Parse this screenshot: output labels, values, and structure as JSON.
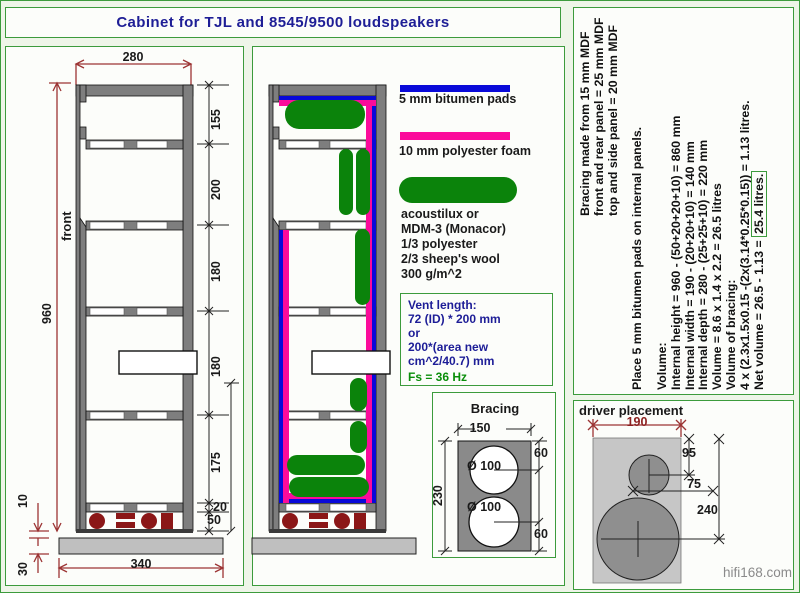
{
  "title": "Cabinet for TJL and 8545/9500 loudspeakers",
  "watermark": "hifi168.com",
  "colors": {
    "border_green": "#3c9b3c",
    "navy_text": "#1d1d97",
    "dim_red": "#9c3434",
    "bitumen_blue": "#0909d9",
    "foam_magenta": "#fb0b9b",
    "acoustilux_green": "#0b830b",
    "wall_gray": "#7e7e7e",
    "feet_dark_red": "#8b1717"
  },
  "left_drawing": {
    "front_label": "front",
    "dim_width": "280",
    "dim_height": "960",
    "dim_s1": "155",
    "dim_s2": "200",
    "dim_s3": "180",
    "dim_s4": "180",
    "dim_s5": "175",
    "dim_s6": "20",
    "dim_s7": "50",
    "dim_gap": "10",
    "dim_plinth_height": "30",
    "dim_plinth_width": "340"
  },
  "legend": {
    "bitumen_label": "5 mm bitumen pads",
    "foam_label": "10 mm polyester foam",
    "acoustilux_lines": [
      "acoustilux or",
      "MDM-3 (Monacor)",
      "1/3 polyester",
      "2/3 sheep's wool",
      "300 g/m^2"
    ]
  },
  "vent": {
    "lines": [
      "Vent length:",
      "72 (ID) * 200 mm",
      "or",
      "200*(area new",
      "cm^2/40.7) mm"
    ],
    "fs_line": "Fs = 36 Hz"
  },
  "bracing": {
    "title": "Bracing",
    "dim_width": "150",
    "dim_height": "230",
    "dim_top": "60",
    "dim_bottom": "60",
    "hole1": "Ø 100",
    "hole2": "Ø 100"
  },
  "driver_placement": {
    "title": "driver placement",
    "dim_width": "190",
    "dim_tweeter": "95",
    "dim_offset": "75",
    "dim_woofer": "240"
  },
  "right_panel": {
    "construction_lines": [
      "Bracing made from 15 mm MDF",
      "front and rear panel = 25 mm MDF",
      "top and side panel = 20 mm MDF"
    ],
    "note": "Place 5 mm bitumen pads on internal panels.",
    "volume_lines": [
      "Volume:",
      "Internal height = 960 - (50+20+20+10) = 860 mm",
      "Internal width = 190 - (20+20+10) = 140 mm",
      "Internal depth = 280 - (25+25+10) = 220 mm",
      "Volume = 8.6 x 1.4 x 2.2 = 26.5 litres",
      "Volume of bracing:",
      "4 x (2.3x1.5x0.15 -(2x(3.14*0.25*0.15)) = 1.13 litres."
    ],
    "net_volume_prefix": "Net volume = 26.5 - 1.13 = ",
    "net_volume_boxed": "25.4 litres."
  }
}
